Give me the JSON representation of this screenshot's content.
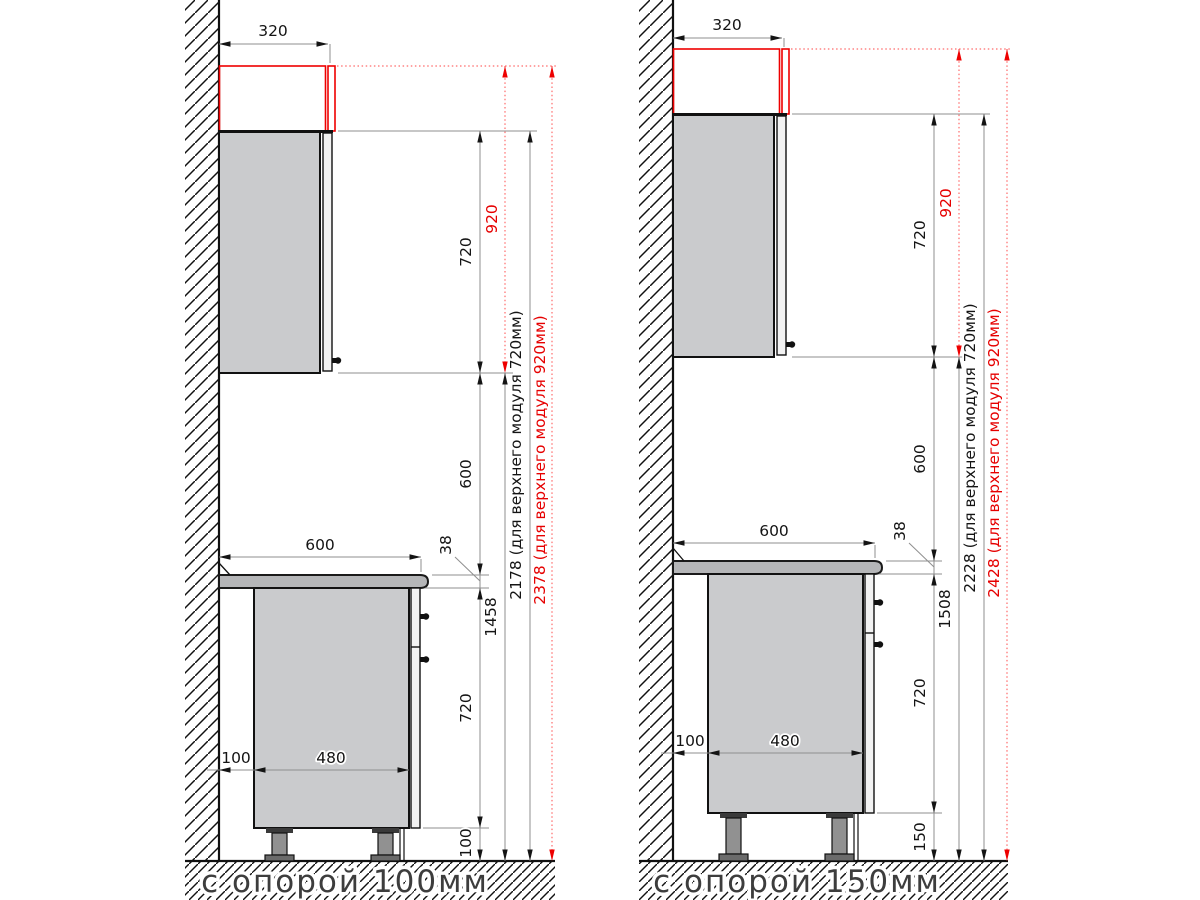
{
  "drawing": {
    "description_labels": {
      "left_floor_label": "с опорой 100мм",
      "right_floor_label": "с опорой 150мм"
    },
    "colors": {
      "accent_red": "#ee0000",
      "dim_line_gray": "#8f8f8f",
      "cabinet_fill": "#cacbcd",
      "counter_fill": "#b5b6b8",
      "door_fill": "#f2f2f2",
      "leg_fill": "#919191",
      "text_black": "#141414"
    },
    "diagrams": [
      {
        "id": "support-100",
        "floor_label": "с опорой 100мм",
        "dims": {
          "top_depth": "320",
          "upper_module_height": "720",
          "upper_module_height_alt": "920",
          "cabinet_to_counter_gap": "600",
          "countertop_thickness": "38",
          "floor_to_upper_cabinet": "1458",
          "base_module_height": "720",
          "leg_height": "100",
          "wall_gap": "100",
          "base_depth": "480",
          "counter_depth": "600",
          "total_height_720": "2178 (для верхнего модуля 720мм)",
          "total_height_920": "2378 (для верхнего модуля 920мм)"
        }
      },
      {
        "id": "support-150",
        "floor_label": "с опорой 150мм",
        "dims": {
          "top_depth": "320",
          "upper_module_height": "720",
          "upper_module_height_alt": "920",
          "cabinet_to_counter_gap": "600",
          "countertop_thickness": "38",
          "floor_to_upper_cabinet": "1508",
          "base_module_height": "720",
          "leg_height": "150",
          "wall_gap": "100",
          "base_depth": "480",
          "counter_depth": "600",
          "total_height_720": "2228 (для верхнего модуля 720мм)",
          "total_height_920": "2428 (для верхнего модуля 920мм)"
        }
      }
    ]
  }
}
